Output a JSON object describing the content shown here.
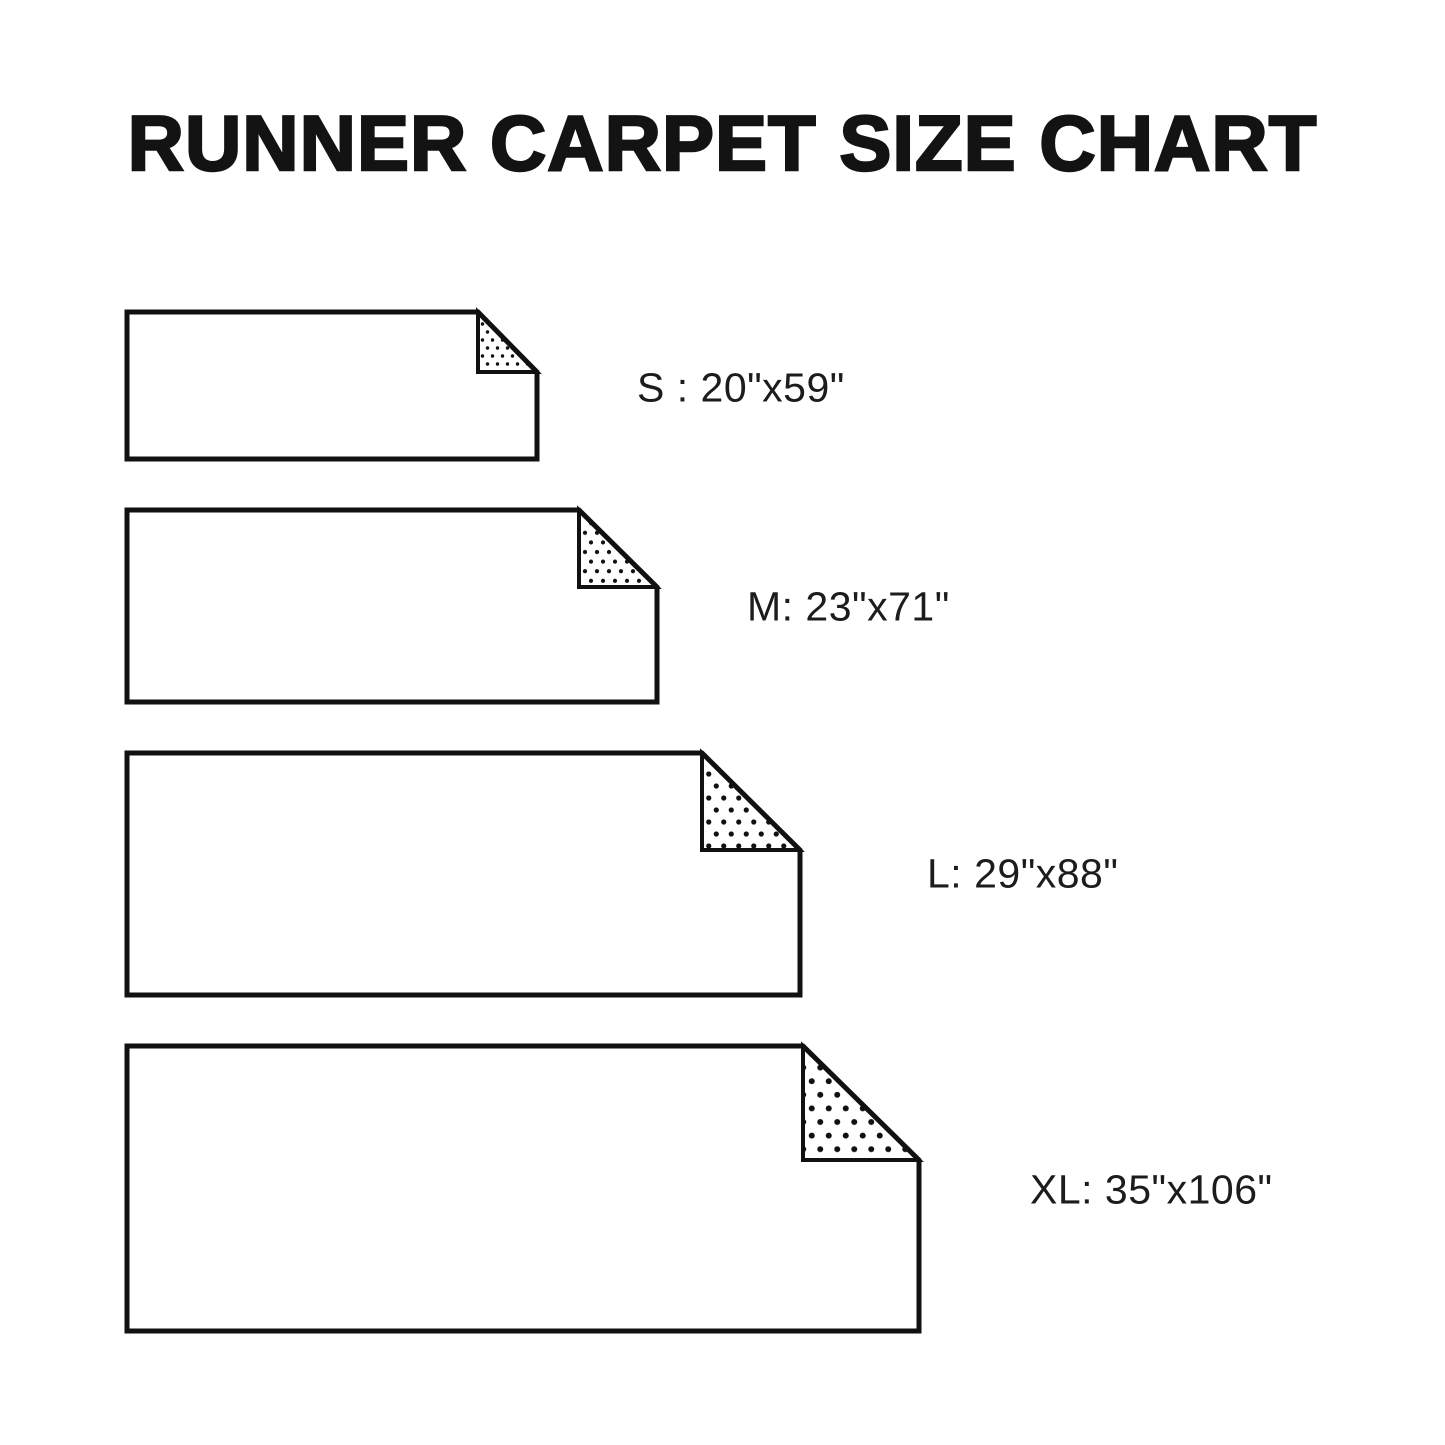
{
  "title": {
    "text": "RUNNER CARPET SIZE CHART"
  },
  "colors": {
    "ink": "#111111",
    "paper": "#ffffff",
    "label_text": "#1c1c1c"
  },
  "sizes": [
    {
      "id": "S",
      "size_code": "S",
      "dimensions": "20\"x59\"",
      "label": "S : 20\"x59\"",
      "rect": {
        "x": 127,
        "y": 312,
        "w": 410,
        "h": 147
      },
      "fold": {
        "w": 59,
        "h": 60
      },
      "dots": {
        "spacing": 10,
        "radius": 1.7
      },
      "label_pos": {
        "x": 637,
        "y": 388
      }
    },
    {
      "id": "M",
      "size_code": "M",
      "dimensions": "23\"x71\"",
      "label": "M: 23\"x71\"",
      "rect": {
        "x": 127,
        "y": 510,
        "w": 530,
        "h": 192
      },
      "fold": {
        "w": 78,
        "h": 77
      },
      "dots": {
        "spacing": 12,
        "radius": 2.1
      },
      "label_pos": {
        "x": 747,
        "y": 607
      }
    },
    {
      "id": "L",
      "size_code": "L",
      "dimensions": "29\"x88\"",
      "label": "L: 29\"x88\"",
      "rect": {
        "x": 127,
        "y": 753,
        "w": 673,
        "h": 242
      },
      "fold": {
        "w": 98,
        "h": 97
      },
      "dots": {
        "spacing": 15,
        "radius": 2.6
      },
      "label_pos": {
        "x": 927,
        "y": 874
      }
    },
    {
      "id": "XL",
      "size_code": "XL",
      "dimensions": "35\"x106\"",
      "label": "XL: 35\"x106\"",
      "rect": {
        "x": 127,
        "y": 1046,
        "w": 792,
        "h": 285
      },
      "fold": {
        "w": 116,
        "h": 114
      },
      "dots": {
        "spacing": 17,
        "radius": 3.0
      },
      "label_pos": {
        "x": 1030,
        "y": 1190
      }
    }
  ]
}
